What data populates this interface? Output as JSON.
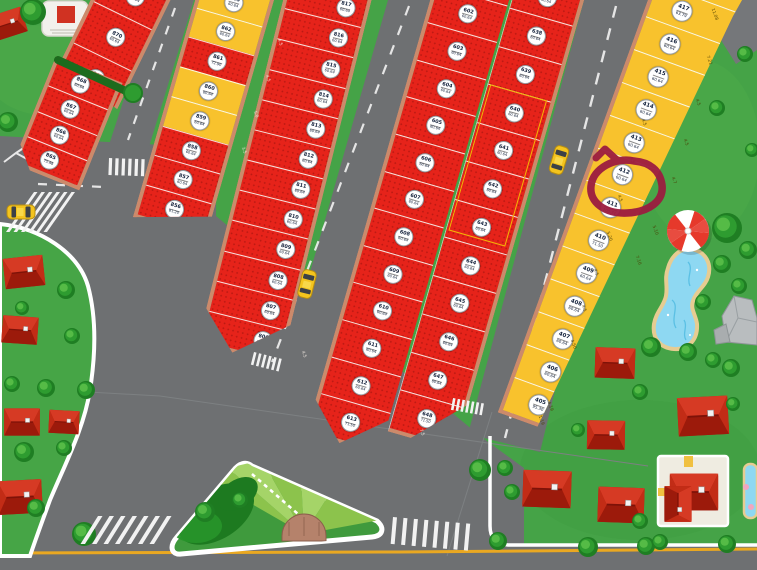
{
  "map": {
    "description": "residential plot map with highlighted lot",
    "highlighted_lot": "412",
    "marker_color": "#9c1c40",
    "colors": {
      "red_lot": "#e6231a",
      "yellow_lot": "#f8c22d",
      "road": "#6e7072",
      "grass": "#45a347",
      "curb": "#cc8a6b"
    },
    "lot_groups": {
      "A": {
        "color": "red",
        "lots": [
          [
            "871",
            "60.64"
          ],
          [
            "870",
            "60.64"
          ],
          [
            "869",
            "72.90"
          ]
        ]
      },
      "B": {
        "color": "red",
        "lots": [
          [
            "868",
            "60.64"
          ],
          [
            "867",
            "60.64"
          ],
          [
            "866",
            "60.64"
          ],
          [
            "865",
            "75.48"
          ]
        ]
      },
      "C": {
        "color": "red",
        "lots": [
          [
            "864",
            "60.64"
          ],
          [
            "863",
            "60.64",
            "yellow"
          ],
          [
            "862",
            "60.64",
            "yellow"
          ],
          [
            "861",
            "72.90"
          ],
          [
            "860",
            "60.64",
            "yellow"
          ],
          [
            "859",
            "60.64",
            "yellow"
          ],
          [
            "858",
            "60.64"
          ],
          [
            "857",
            "60.64"
          ],
          [
            "856",
            "81.20"
          ]
        ]
      },
      "D": {
        "color": "red",
        "lots": [
          [
            "818",
            "72.90"
          ],
          [
            "817",
            "60.64"
          ],
          [
            "816",
            "60.64"
          ],
          [
            "815",
            "60.64"
          ],
          [
            "814",
            "60.64"
          ],
          [
            "813",
            "60.64"
          ],
          [
            "812",
            "60.64"
          ],
          [
            "811",
            "60.64"
          ],
          [
            "810",
            "60.64"
          ],
          [
            "809",
            "60.64"
          ],
          [
            "808",
            "60.64"
          ],
          [
            "807",
            "60.64"
          ],
          [
            "806",
            "75.48"
          ]
        ]
      },
      "EL": {
        "color": "red",
        "lots": [
          [
            "601",
            "63.79"
          ],
          [
            "602",
            "60.64"
          ],
          [
            "603",
            "60.64"
          ],
          [
            "604",
            "60.64"
          ],
          [
            "605",
            "60.64"
          ],
          [
            "606",
            "60.64"
          ],
          [
            "607",
            "60.64"
          ],
          [
            "608",
            "60.64"
          ],
          [
            "609",
            "60.64"
          ],
          [
            "610",
            "60.64"
          ],
          [
            "611",
            "60.64"
          ],
          [
            "612",
            "60.64"
          ],
          [
            "613",
            "71.50"
          ]
        ]
      },
      "ER": {
        "color": "red",
        "lots": [
          [
            "637",
            "60.64"
          ],
          [
            "638",
            "60.64"
          ],
          [
            "639",
            "60.64"
          ],
          [
            "640",
            "60.64"
          ],
          [
            "641",
            "60.64"
          ],
          [
            "642",
            "60.64"
          ],
          [
            "643",
            "60.64"
          ],
          [
            "644",
            "60.64"
          ],
          [
            "645",
            "60.64"
          ],
          [
            "646",
            "60.64"
          ],
          [
            "647",
            "60.64"
          ],
          [
            "648",
            "71.50"
          ]
        ]
      },
      "F": {
        "color": "yellow",
        "lots": [
          [
            "418",
            "63.79"
          ],
          [
            "417",
            "63.79"
          ],
          [
            "416",
            "60.64"
          ],
          [
            "415",
            "60.64"
          ],
          [
            "414",
            "60.64"
          ],
          [
            "413",
            "60.64"
          ],
          [
            "412",
            "60.64",
            "circled"
          ],
          [
            "411",
            "100.71"
          ],
          [
            "410",
            "71.50"
          ],
          [
            "409",
            "60.64"
          ],
          [
            "408",
            "60.64"
          ],
          [
            "407",
            "60.64"
          ],
          [
            "406",
            "60.64"
          ],
          [
            "405",
            "95.30"
          ]
        ]
      }
    },
    "dim_labels": [
      {
        "t": "11.08",
        "x": 708,
        "y": 12
      },
      {
        "t": "7.21",
        "x": 704,
        "y": 58
      },
      {
        "t": "4.5",
        "x": 694,
        "y": 100
      },
      {
        "t": "4.5",
        "x": 682,
        "y": 140
      },
      {
        "t": "4.7",
        "x": 670,
        "y": 178
      },
      {
        "t": "5.10",
        "x": 650,
        "y": 228
      },
      {
        "t": "7.16",
        "x": 633,
        "y": 258
      },
      {
        "t": "4.5",
        "x": 640,
        "y": 120
      },
      {
        "t": "4.5",
        "x": 628,
        "y": 158
      },
      {
        "t": "4.5",
        "x": 616,
        "y": 196
      },
      {
        "t": "5.20",
        "x": 604,
        "y": 234
      },
      {
        "t": "4.5",
        "x": 592,
        "y": 270
      },
      {
        "t": "4.5",
        "x": 580,
        "y": 306
      },
      {
        "t": "4.50",
        "x": 568,
        "y": 342
      },
      {
        "t": "4.19",
        "x": 545,
        "y": 404
      },
      {
        "t": "1.19",
        "x": 536,
        "y": 418
      },
      {
        "t": "4.5",
        "x": 276,
        "y": 40,
        "lt": 1
      },
      {
        "t": "4.5",
        "x": 264,
        "y": 76,
        "lt": 1
      },
      {
        "t": "5.0",
        "x": 252,
        "y": 112,
        "lt": 1
      },
      {
        "t": "3.5",
        "x": 240,
        "y": 148,
        "lt": 1
      },
      {
        "t": "4.5",
        "x": 300,
        "y": 352,
        "lt": 1
      },
      {
        "t": "7.5",
        "x": 418,
        "y": 430,
        "lt": 1
      }
    ]
  }
}
